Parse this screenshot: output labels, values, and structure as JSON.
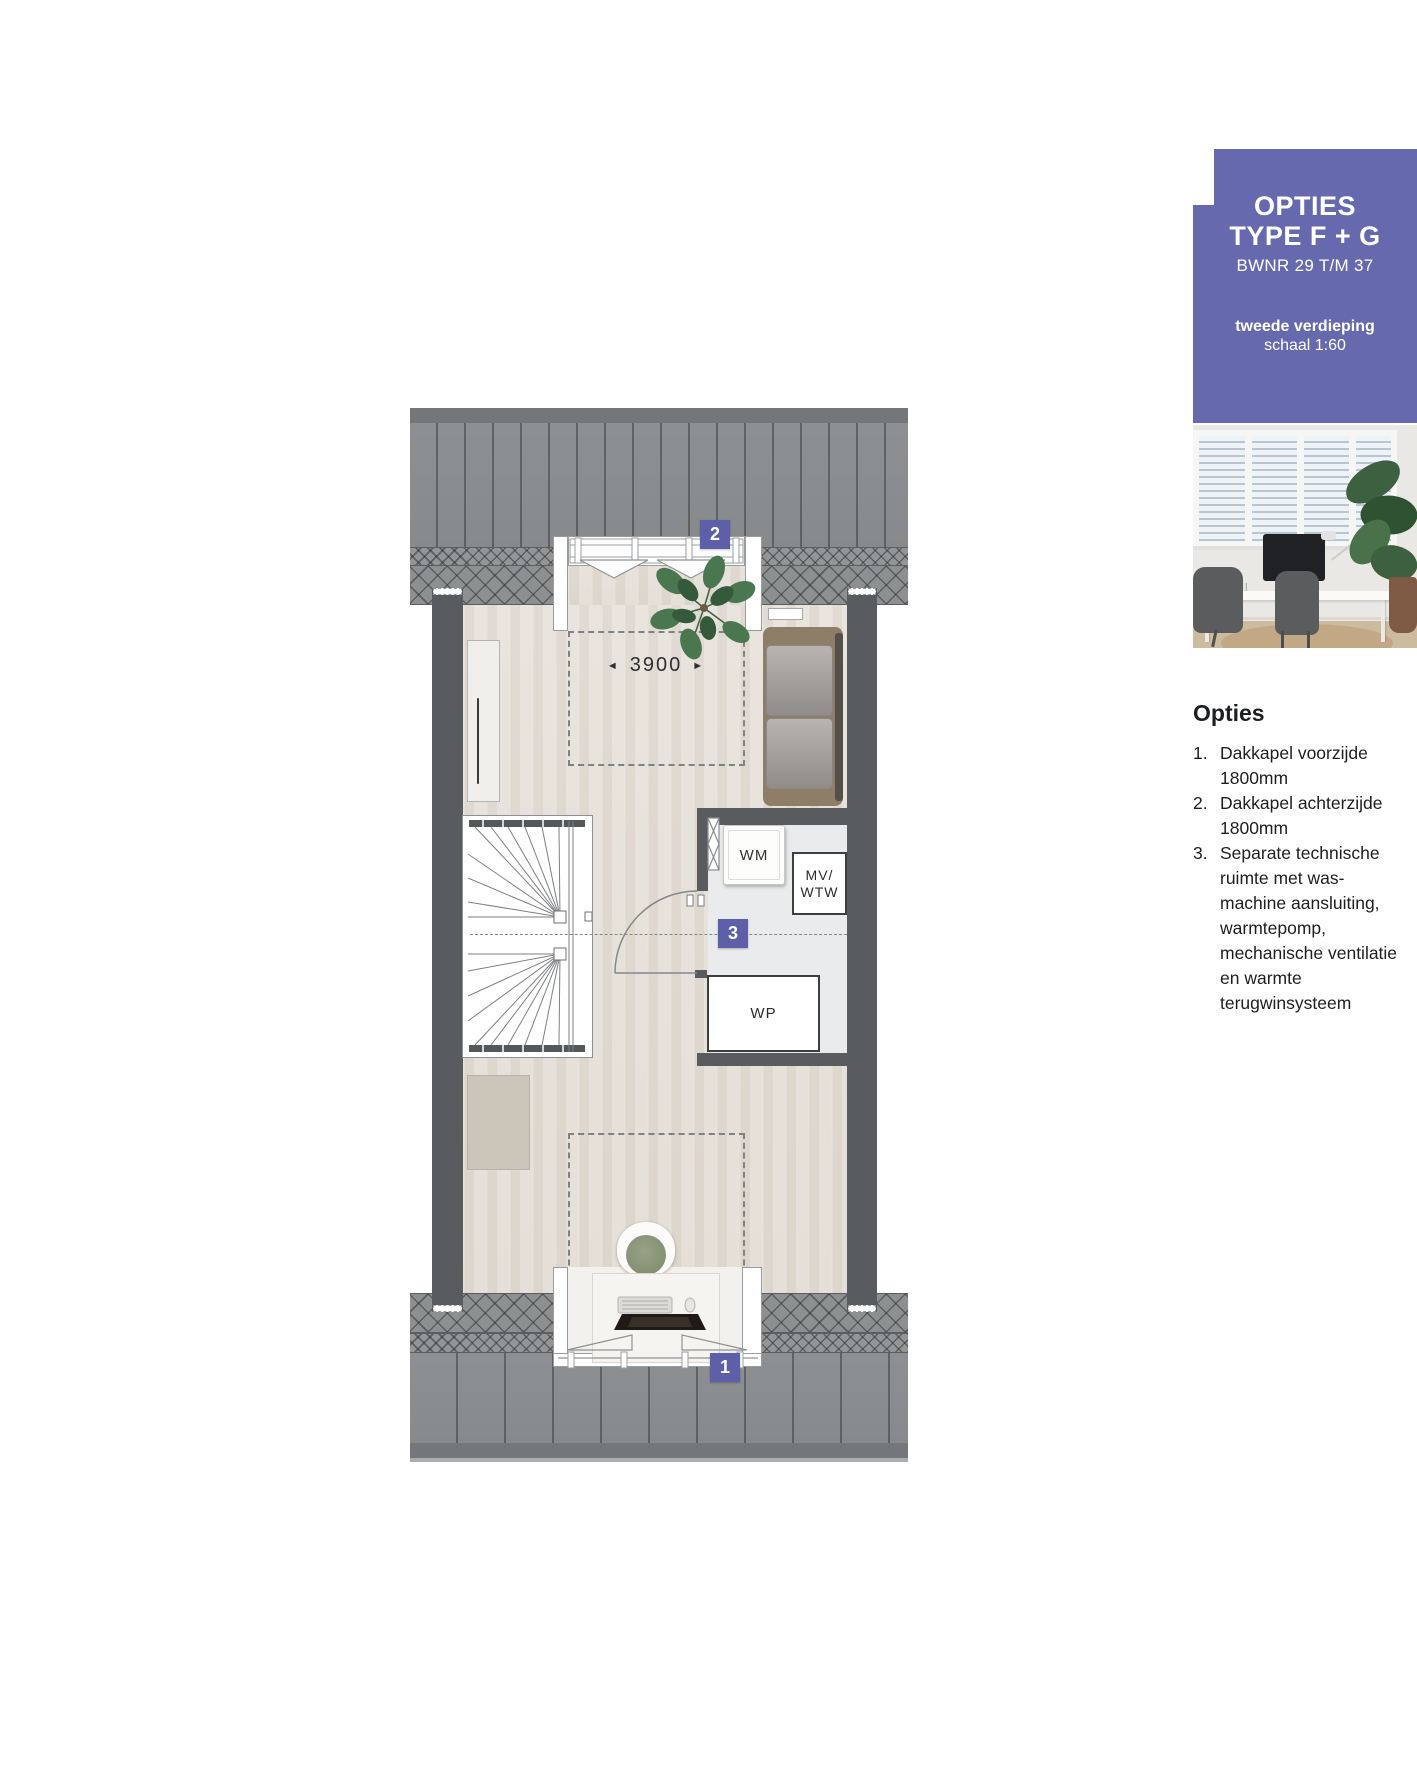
{
  "panel": {
    "title1": "OPTIES",
    "title2": "TYPE F + G",
    "bwnr": "BWNR 29 T/M 37",
    "floor": "tweede verdieping",
    "scale": "schaal 1:60"
  },
  "options": {
    "heading": "Opties",
    "items": [
      {
        "num": "1.",
        "text": "Dakkapel voorzijde 1800mm"
      },
      {
        "num": "2.",
        "text": "Dakkapel achterzijde 1800mm"
      },
      {
        "num": "3.",
        "text": "Separate technische ruimte met was-machine aansluiting, warmtepomp, mechanische ventilatie en warmte terugwinsysteem"
      }
    ]
  },
  "plan": {
    "dimension": {
      "arrow_left": "◄",
      "value": "3900",
      "arrow_right": "►"
    },
    "marker1": "1",
    "marker2": "2",
    "marker3": "3",
    "labels": {
      "wm": "WM",
      "mv": "MV/",
      "wtw": "WTW",
      "wp": "WP"
    }
  },
  "colors": {
    "accent": "#6769ae",
    "badge": "#5d60a9",
    "wall": "#585c5e",
    "roof": "#8a8d8f",
    "wood_floor": "#e5dfd8",
    "tech_floor": "#e9ebec"
  }
}
